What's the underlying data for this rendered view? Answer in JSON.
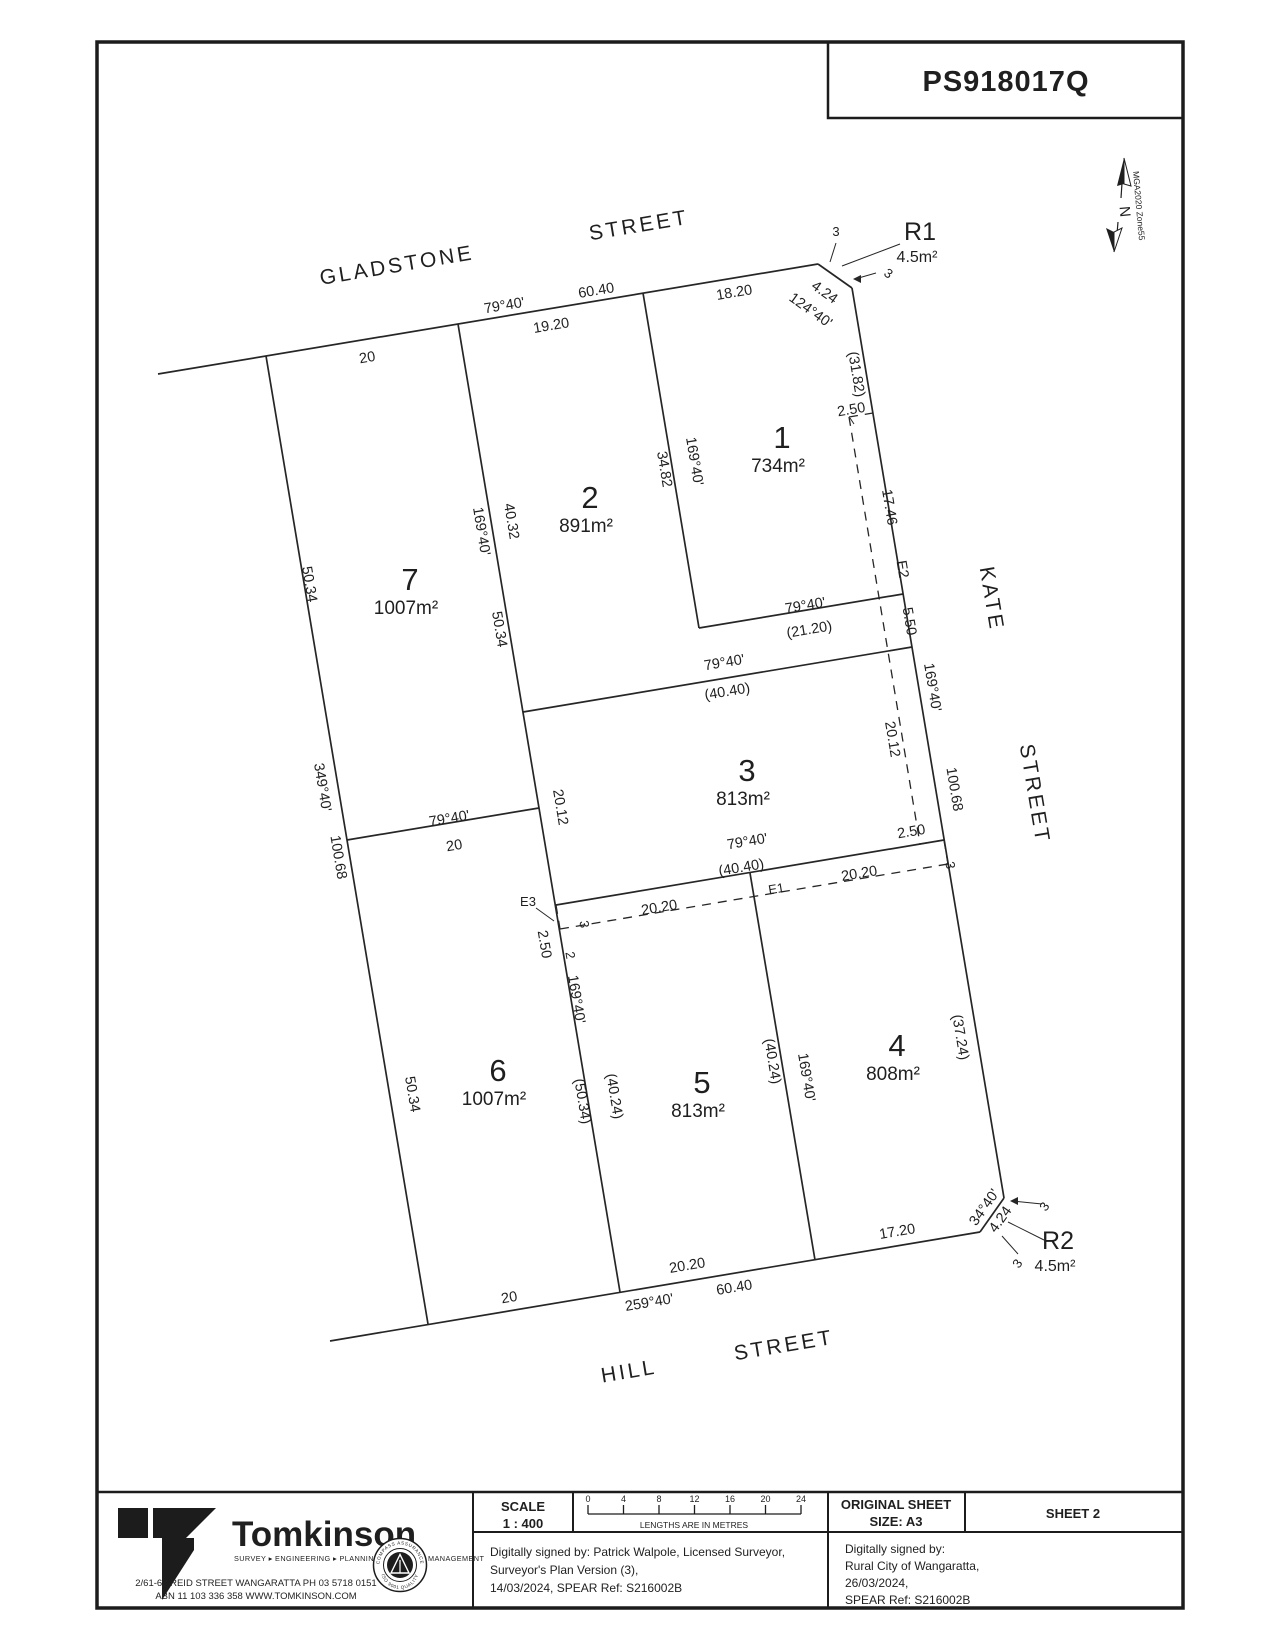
{
  "plan_number": "PS918017Q",
  "north": {
    "n": "N",
    "datum": "MGA2020 Zone55"
  },
  "streets": {
    "gladstone_1": "GLADSTONE",
    "gladstone_2": "STREET",
    "kate_1": "KATE",
    "kate_2": "STREET",
    "hill_1": "HILL",
    "hill_2": "STREET"
  },
  "lots": [
    {
      "n": "1",
      "a": "734m²"
    },
    {
      "n": "2",
      "a": "891m²"
    },
    {
      "n": "3",
      "a": "813m²"
    },
    {
      "n": "4",
      "a": "808m²"
    },
    {
      "n": "5",
      "a": "813m²"
    },
    {
      "n": "6",
      "a": "1007m²"
    },
    {
      "n": "7",
      "a": "1007m²"
    }
  ],
  "reserves": {
    "r1": "R1",
    "r2": "R2",
    "area": "4.5m²"
  },
  "m": {
    "b79": "79°40'",
    "b169": "169°40'",
    "b349": "349°40'",
    "b259": "259°40'",
    "b124": "124°40'",
    "b34": "34°40'",
    "d6040": "60.40",
    "d20": "20",
    "d1920": "19.20",
    "d1820": "18.20",
    "d424": "4.24",
    "d3": "3",
    "d2": "2",
    "d5034": "50.34",
    "d10068": "100.68",
    "d4032": "40.32",
    "d3482": "34.82",
    "d3182": "(31.82)",
    "d1746": "17.46",
    "d550": "5.50",
    "d2120": "(21.20)",
    "d4040": "(40.40)",
    "d2012": "20.12",
    "d250": "2.50",
    "d2020": "20.20",
    "d4024": "(40.24)",
    "d5034b": "(50.34)",
    "d3724": "(37.24)",
    "d1720": "17.20",
    "e1": "E1",
    "e2": "E2",
    "e3": "E3"
  },
  "title_block": {
    "scale_label": "SCALE",
    "scale_ratio": "1 : 400",
    "ticks": [
      "0",
      "4",
      "8",
      "12",
      "16",
      "20",
      "24"
    ],
    "units_note": "LENGTHS ARE IN METRES",
    "original_sheet_1": "ORIGINAL SHEET",
    "original_sheet_2": "SIZE: A3",
    "sheet": "SHEET  2",
    "surveyor_sig": [
      "Digitally signed by: Patrick Walpole, Licensed Surveyor,",
      "Surveyor's Plan Version (3),",
      "14/03/2024, SPEAR Ref: S216002B"
    ],
    "council_sig": [
      "Digitally signed by:",
      "Rural City of Wangaratta,",
      "26/03/2024,",
      "SPEAR Ref: S216002B"
    ],
    "firm": {
      "name": "Tomkinson",
      "tagline": "SURVEY ▸ ENGINEERING ▸ PLANNING ▸ PROJECT MANAGEMENT",
      "address1": "2/61-63 REID STREET WANGARATTA   PH 03 5718 0151",
      "address2": "ABN 11 103 336 358   WWW.TOMKINSON.COM",
      "badge_top": "COMPASS ASSURANCE",
      "badge_bottom": "ISO 9001 QUALITY"
    }
  }
}
